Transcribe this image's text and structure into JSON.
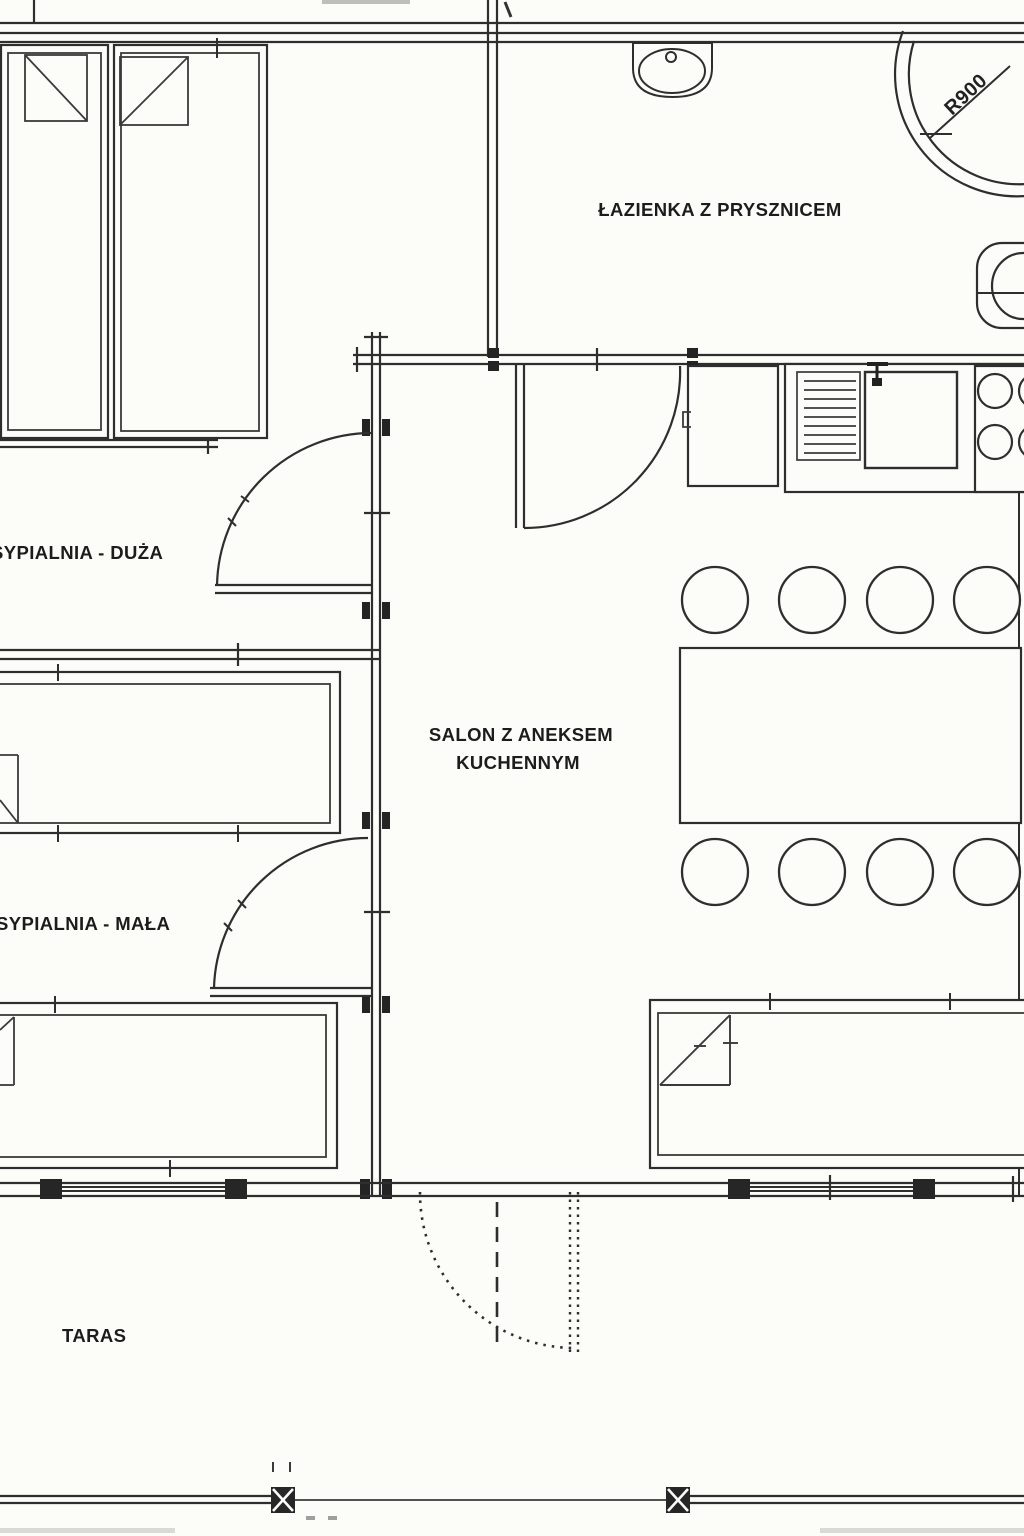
{
  "plan": {
    "rooms": [
      {
        "id": "bathroom",
        "label": "ŁAZIENKA Z PRYSZNICEM"
      },
      {
        "id": "bedroom-large",
        "label": "SYPIALNIA - DUŻA"
      },
      {
        "id": "living-kitchen",
        "label_line1": "SALON Z ANEKSEM",
        "label_line2": "KUCHENNYM"
      },
      {
        "id": "bedroom-small",
        "label": "SYPIALNIA - MAŁA"
      },
      {
        "id": "terrace",
        "label": "TARAS"
      }
    ],
    "annotations": {
      "shower_radius": "R900"
    },
    "colors": {
      "paper": "#fcfcf8",
      "ink": "#2e2e2e",
      "text": "#1c1c1c"
    }
  }
}
